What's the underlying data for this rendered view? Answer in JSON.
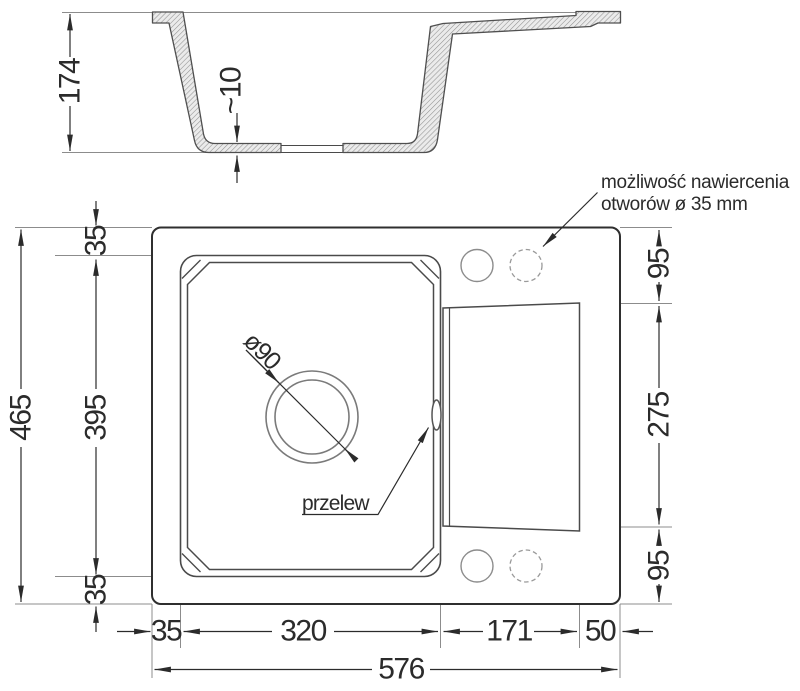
{
  "note": {
    "line1": "możliwość nawiercenia",
    "line2": "otworów ø 35 mm"
  },
  "labels": {
    "overflow": "przelew",
    "drain_diameter": "ø90",
    "bottom_thickness": "~10"
  },
  "dims": {
    "depth": "174",
    "total_height": "465",
    "bowl_height": "395",
    "rim_top": "35",
    "rim_bottom": "35",
    "rim_left": "35",
    "bowl_width": "320",
    "drainboard_width": "171",
    "right_ledge": "50",
    "total_width": "576",
    "band_top": "95",
    "drainboard_height": "275",
    "band_bottom": "95"
  }
}
